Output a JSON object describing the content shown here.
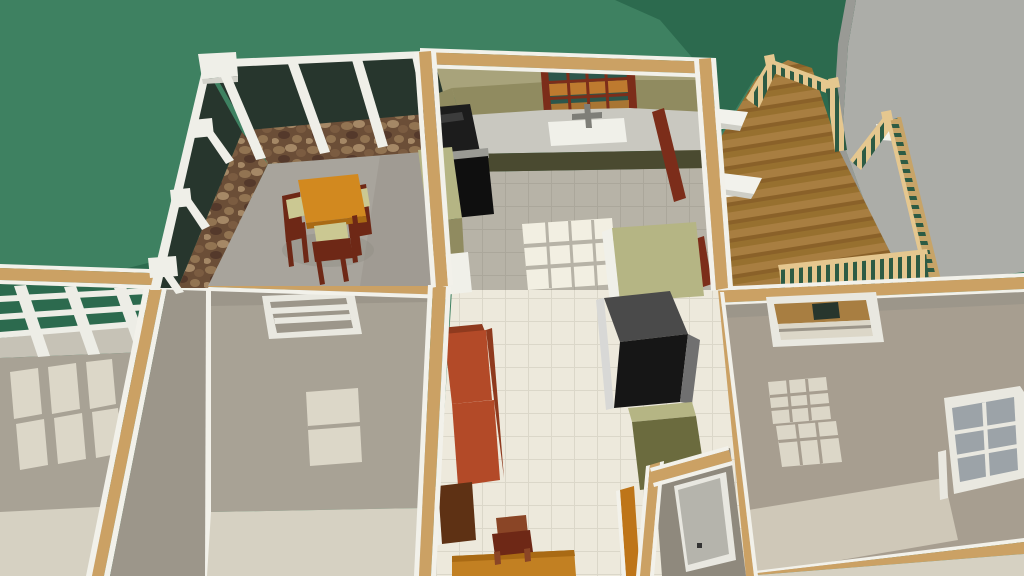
{
  "meta": {
    "description": "Overhead 3D dollhouse rendering of a house: screened porch with dining set, kitchen, wood deck, and lower rooms",
    "view": "overhead-perspective-render"
  },
  "inventory": {
    "areas": [
      "lawn",
      "concrete-walkway",
      "screened-porch",
      "kitchen",
      "wood-deck",
      "left-room",
      "middle-room",
      "right-room",
      "closet",
      "hallway"
    ],
    "objects": [
      "porch-dining-table",
      "porch-chairs",
      "stone-knee-wall",
      "porch-posts",
      "kitchen-window",
      "kitchen-sink",
      "kitchen-faucet",
      "range-cooktop",
      "oven",
      "refrigerator",
      "kitchen-island",
      "red-hutch",
      "deck-railings",
      "deck-brackets",
      "pergola-beams",
      "room-windows",
      "closet-door",
      "breakfast-table",
      "chair"
    ]
  },
  "colors": {
    "grass": "#3E8161",
    "grass_shadow": "#2C6A4E",
    "concrete": "#ACADA8",
    "concrete_edge": "#999A95",
    "plank_a": "#A87E41",
    "plank_b": "#8A6129",
    "plank_c": "#97702F",
    "railing": "#E5C78F",
    "railing_dark": "#C7A468",
    "railing_gap": "#2D5B44",
    "bracket_white": "#F2F2EC",
    "bracket_shadow": "#CECEC6",
    "glass_dark": "#27362D",
    "stone_base": "#6B4E37",
    "stone_a": "#927452",
    "stone_b": "#54392B",
    "stone_c": "#A58866",
    "stone_d": "#7B5C41",
    "porch_floor": "#A8A49C",
    "porch_floor_shadow": "#918D85",
    "post_white": "#EFEFE8",
    "post_shade": "#D2D2CA",
    "cap_wood": "#CBA164",
    "trim_white": "#F2F1EA",
    "kitchen_wall": "#A8A37B",
    "cabinet_upper": "#908B60",
    "cabinet_lower": "#6B6B3E",
    "cabinet_dark": "#4A4A30",
    "counter": "#C9C8C0",
    "sink_white": "#F0F0E9",
    "faucet_gray": "#7E7E78",
    "window_frame": "#7C2D1A",
    "pane_teal": "#2C564B",
    "pane_orange": "#BE7A2F",
    "range_black": "#1C1C1C",
    "range_gloss": "#3C3C3C",
    "oven_black": "#0F0F0F",
    "steel": "#9A9A94",
    "island_top": "#B5B584",
    "fridge_top": "#4A4A4A",
    "fridge_front": "#161616",
    "fridge_side": "#707070",
    "fridge_edge": "#D8D8D6",
    "hutch_red": "#B34A28",
    "hutch_red_dark": "#8F3A1E",
    "dark_cabinet": "#5E3114",
    "tile_gray": "#B7B3A7",
    "tile_gray_line": "#ABA79B",
    "tile_white": "#EDE9DC",
    "tile_line": "#DBD7C9",
    "light_patch": "#F2EFE2",
    "room_patch": "#DCD7C8",
    "room_floor": "#A8A295",
    "room_floor_light": "#D6D1C2",
    "room_floor_right": "#A79E90",
    "room_floor_right_light": "#CFC8B8",
    "wall_face": "#9C968A",
    "closet_floor": "#8F897D",
    "door_panel": "#B5B4AC",
    "door_frame_white": "#E8E7E0",
    "handle": "#333333",
    "orange_door_frame": "#BE7519",
    "table_orange": "#D2891F",
    "table_edge": "#A96A14",
    "chair_wood": "#6E2816",
    "cushion": "#CBC892",
    "pergola_white": "#EDEDE6",
    "pergola_floor": "#C6C2B6",
    "window_white": "#E9E8E0",
    "pane_gray": "#9CA3A8",
    "bottom_table_orange": "#C28022",
    "small_chair": "#8A4526"
  }
}
